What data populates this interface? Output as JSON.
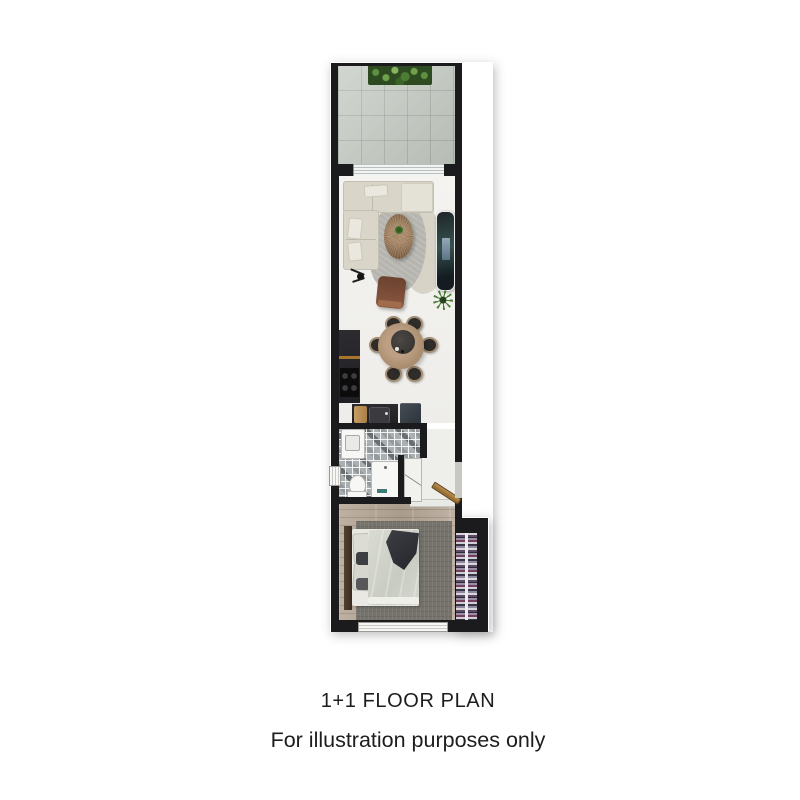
{
  "caption": {
    "title": "1+1 FLOOR PLAN",
    "subtitle": "For illustration purposes only"
  },
  "plan": {
    "type": "apartment-floor-plan-1plus1",
    "rooms": [
      {
        "name": "balcony",
        "features": [
          "stone-tile-floor",
          "planter-box",
          "sliding-door-threshold"
        ]
      },
      {
        "name": "living-dining-room",
        "features": [
          "l-shaped-sofa",
          "organic-area-rug",
          "round-coffee-table",
          "floor-lamp",
          "leather-armchair",
          "tv-unit",
          "potted-plant",
          "round-dining-table",
          "six-dining-chairs"
        ]
      },
      {
        "name": "kitchen",
        "features": [
          "tall-cabinet",
          "cooktop-4-burners",
          "sink-counter",
          "cutting-board",
          "fridge"
        ]
      },
      {
        "name": "bathroom",
        "features": [
          "mosaic-tile-floor",
          "washbasin-unit",
          "toilet",
          "shower-washer-unit",
          "bathroom-door",
          "side-window"
        ]
      },
      {
        "name": "entry-hall",
        "features": [
          "entry-door-swing",
          "doorway-opening"
        ]
      },
      {
        "name": "bedroom",
        "features": [
          "wood-plank-floor",
          "double-bed",
          "headboard",
          "pillows",
          "duvet",
          "throw-blanket",
          "area-rug",
          "open-wardrobe-hanging-clothes",
          "bottom-window"
        ]
      }
    ]
  },
  "colors": {
    "wall": "#1b1b1d",
    "balcony_tile": "#bfc5bd",
    "living_floor": "#f3f2ef",
    "wood_floor": "#b6a898",
    "mosaic_base": "#aab0b1",
    "sofa": "#d9d6c9",
    "rug_grey": "#b5b4ae",
    "rug_beige": "#d7d3c6",
    "table_wood": "#a98c6d",
    "armchair": "#7a4b34",
    "counter_dark": "#242428",
    "fridge": "#394048",
    "bedroom_rug": "#76736c",
    "duvet": "#d4d6ce",
    "throw": "#34363b",
    "plant_green": "#4c7d33",
    "door_wood": "#a77f44",
    "text": "#1d1d1d"
  }
}
